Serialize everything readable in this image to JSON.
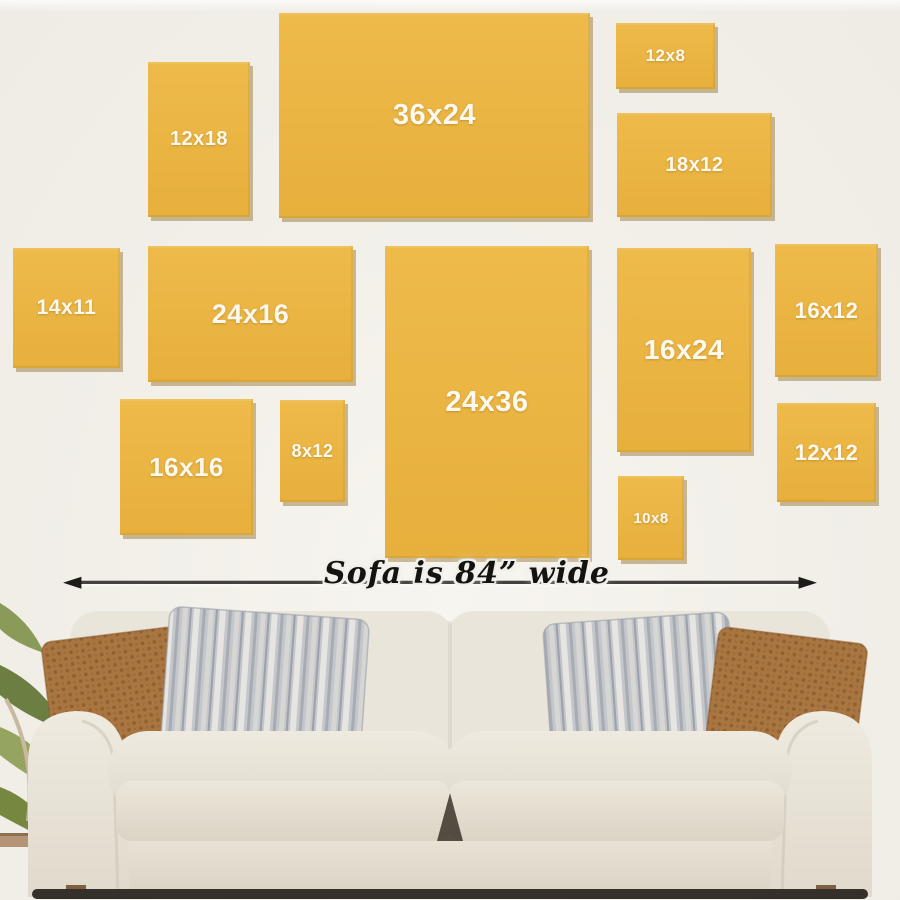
{
  "page": {
    "description": "Wall art canvas size comparison guide displayed above a sofa",
    "wall_color": "#F1EFE9",
    "frame_color": "#EBB545",
    "frame_label_color": "#FDF9EF"
  },
  "frames": [
    {
      "label": "12x18"
    },
    {
      "label": "36x24"
    },
    {
      "label": "12x8"
    },
    {
      "label": "18x12"
    },
    {
      "label": "14x11"
    },
    {
      "label": "24x16"
    },
    {
      "label": "24x36"
    },
    {
      "label": "16x24"
    },
    {
      "label": "16x12"
    },
    {
      "label": "16x16"
    },
    {
      "label": "8x12"
    },
    {
      "label": "10x8"
    },
    {
      "label": "12x12"
    }
  ],
  "sofa": {
    "width_label": "Sofa is 84” wide",
    "arrow_color": "#2B2A28",
    "fabric_color": "#E9E4DA",
    "pillow_rust_color": "#A97540",
    "pillow_stripe_color": "#C3C6CB",
    "plant_color": "#7D8F4E"
  },
  "icons": {
    "arrowhead_left": "◄",
    "arrowhead_right": "►"
  }
}
